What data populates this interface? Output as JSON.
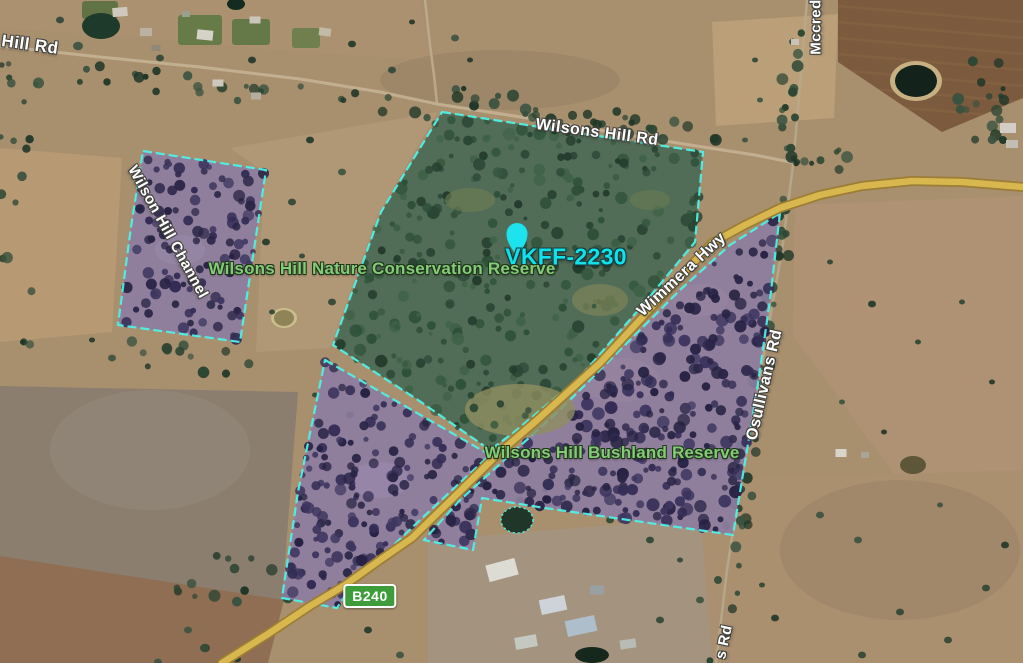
{
  "app": {
    "type": "satellite-map"
  },
  "marker": {
    "label": "VKFF-2230"
  },
  "areas": {
    "nature_reserve": "Wilsons Hill Nature Conservation Reserve",
    "bushland_reserve": "Wilsons Hill Bushland Reserve"
  },
  "roads": {
    "hill_rd": "Hill Rd",
    "wilsons_hill_rd": "Wilsons Hill Rd",
    "wimmera_hwy": "Wimmera Hwy",
    "osullivans_rd": "Osullivans Rd",
    "osullivans_rd_partial": "s Rd",
    "mccredden_partial": "Mccred",
    "route_shield": "B240"
  },
  "features": {
    "channel": "Wilson Hill Channel"
  },
  "colors": {
    "boundary": "#4ff0e6",
    "marker": "#1ce3ee",
    "marker_label": "#0fe2ea",
    "reserve_label": "#84cb78",
    "road_label": "#ffffff",
    "route_shield_bg": "#3f9c3a",
    "purple_overlay": "#8d7da1",
    "green_overlay": "#4d6b55",
    "highway": "#d7b74e"
  }
}
